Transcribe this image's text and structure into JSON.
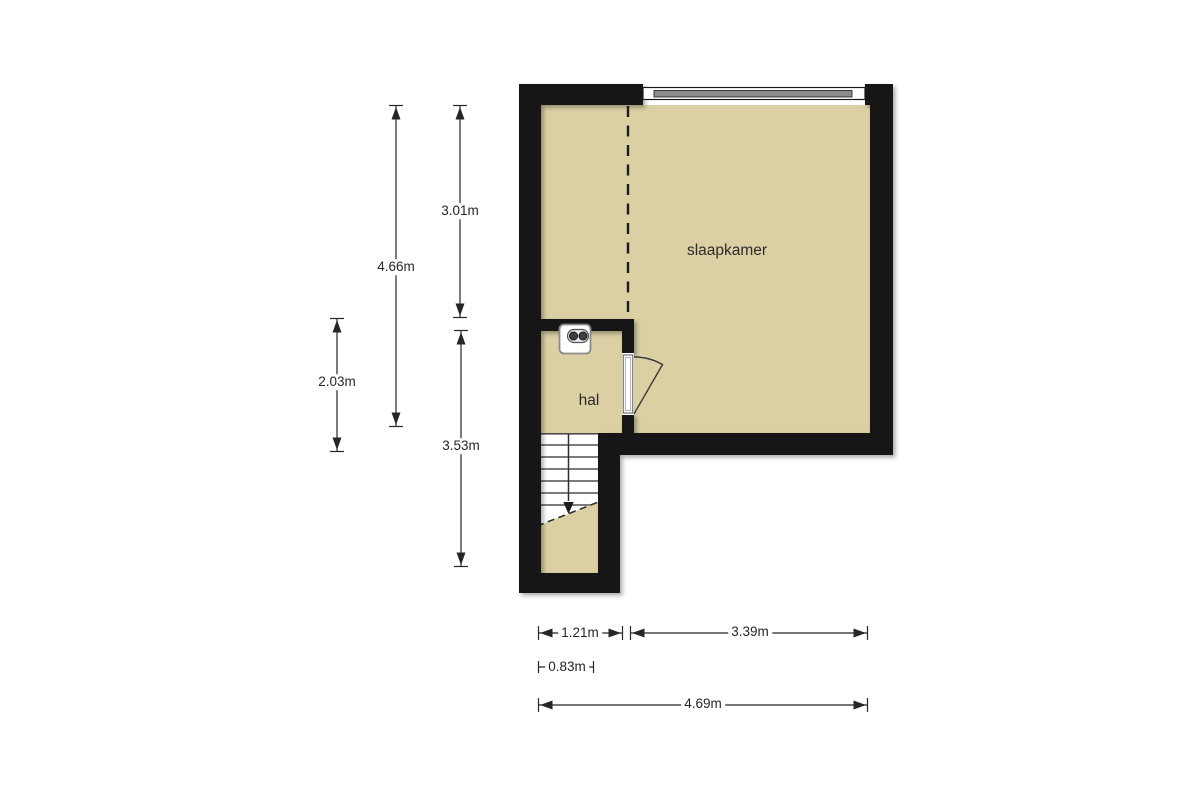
{
  "floorplan": {
    "rooms": [
      {
        "id": "slaapkamer",
        "label": "slaapkamer"
      },
      {
        "id": "hal",
        "label": "hal"
      }
    ],
    "dimensions": {
      "left_outer_height": "4.66m",
      "upper_inner_height": "3.01m",
      "hal_height": "2.03m",
      "lower_inner_height": "3.53m",
      "stairwell_width": "1.21m",
      "bedroom_width": "3.39m",
      "stair_inner_width": "0.83m",
      "total_width": "4.69m"
    },
    "features": {
      "window": "window",
      "door": "door-swing",
      "stairs": "staircase-with-break-line",
      "fixture": "wall-outlet-fixture",
      "dashed_line": "ceiling-height-line"
    },
    "colors": {
      "floor": "#dbcfa4",
      "wall": "#141414",
      "line": "#262626",
      "window_glass": "#8c8c8c",
      "background": "#ffffff"
    }
  }
}
